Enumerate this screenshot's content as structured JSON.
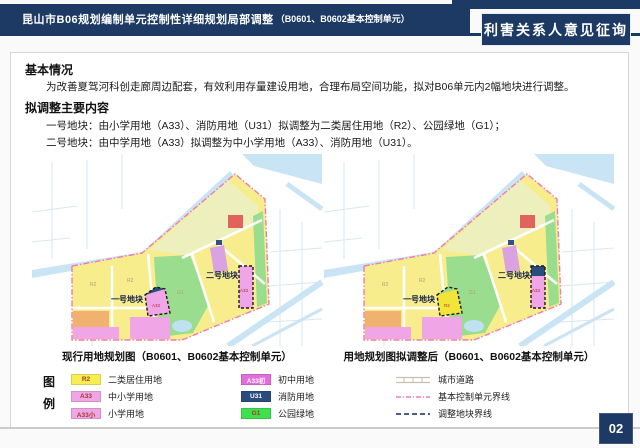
{
  "header": {
    "title_main": "昆山市B06规划编制单元控制性详细规划局部调整",
    "title_sub": "（B0601、B0602基本控制单元）",
    "badge": "利害关系人意见征询"
  },
  "sections": {
    "basic_heading": "基本情况",
    "basic_text": "为改善夏驾河科创走廊周边配套，有效利用存量建设用地，合理布局空间功能，拟对B06单元内2幅地块进行调整。",
    "adjust_heading": "拟调整主要内容",
    "items": [
      "一号地块：由小学用地（A33）、消防用地（U31）拟调整为二类居住用地（R2）、公园绿地（G1）；",
      "二号地块：由中学用地（A33）拟调整为中小学用地（A33）、消防用地（U31）。"
    ]
  },
  "maps": [
    {
      "caption": "现行用地规划图（B0601、B0602基本控制单元）",
      "plot1_label": "一号地块",
      "plot2_label": "二号地块",
      "plot1_fill": "#f0a5e7",
      "plot1_corner_fill": "#2b4d7e",
      "plot1_code": "A33",
      "plot2_fill": "#f0a5e7",
      "plot2_fire_fill": "none",
      "plot2_code": "A33"
    },
    {
      "caption": "用地规划图拟调整后（B0601、B0602基本控制单元）",
      "plot1_label": "一号地块",
      "plot2_label": "二号地块",
      "plot1_fill": "#f2e438",
      "plot1_corner_fill": "#9bdd8e",
      "plot1_code": "R2",
      "plot2_fill": "#f0a5e7",
      "plot2_fire_fill": "#2b4d7e",
      "plot2_code": "A33"
    }
  ],
  "codes": {
    "r2": "R2",
    "g1": "G1"
  },
  "legend": {
    "title_chars": [
      "图",
      "例"
    ],
    "items": [
      {
        "code": "R2",
        "label": "二类居住用地",
        "bg": "#f7ef52",
        "fg": "#a63a2a"
      },
      {
        "code": "A33",
        "label": "中小学用地",
        "bg": "#f0a5e7",
        "fg": "#a63a2a"
      },
      {
        "code": "A33小",
        "label": "小学用地",
        "bg": "#f0a5e7",
        "fg": "#a63a2a"
      },
      {
        "code": "A33初",
        "label": "初中用地",
        "bg": "#e46ddd",
        "fg": "#ffffff"
      },
      {
        "code": "U31",
        "label": "消防用地",
        "bg": "#2b4d7e",
        "fg": "#ffffff"
      },
      {
        "code": "G1",
        "label": "公园绿地",
        "bg": "#3fe04d",
        "fg": "#a63a2a"
      }
    ],
    "lines": [
      {
        "label": "城市道路"
      },
      {
        "label": "基本控制单元界线"
      },
      {
        "label": "调整地块界线"
      }
    ]
  },
  "page_number": "02",
  "colors": {
    "navy": "#1d3a64",
    "boundary_pink": "#f07ab5",
    "adjust_line_blue": "#2c4a7c",
    "water_blue": "#c9e4f4",
    "park_green": "#9bdd8e",
    "residential_yellow": "#f8ed8d",
    "school_pink": "#f0a5e7",
    "fire_navy": "#2b4d7e"
  }
}
